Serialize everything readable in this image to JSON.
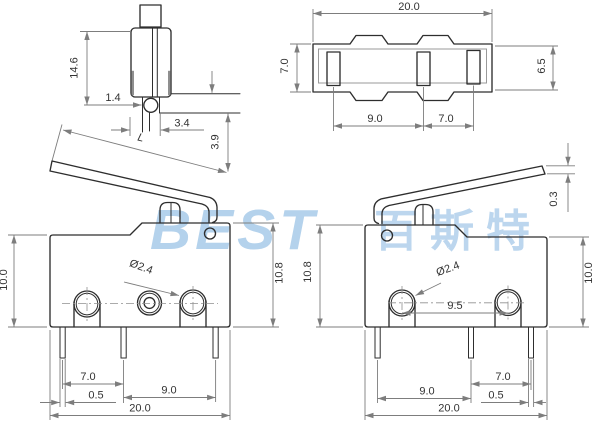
{
  "watermark": {
    "latin": "BEST",
    "cjk": "百斯特"
  },
  "colors": {
    "background": "#ffffff",
    "outline": "#2e2e2e",
    "dimension_lines": "#7d7d7d",
    "label_text": "#333333",
    "watermark_blue": "#b4d2ec"
  },
  "views": {
    "plunger_detail": {
      "dims": {
        "height": "14.6",
        "pin_offset": "1.4",
        "base_width": "3.4",
        "overtravel": "3.9",
        "lever_length": "L"
      }
    },
    "bottom_view": {
      "dims": {
        "width": "20.0",
        "depth": "7.0",
        "inner_depth": "6.5",
        "terminal_pitch_left": "9.0",
        "terminal_pitch_right": "7.0"
      }
    },
    "front_view_left": {
      "dims": {
        "body_height": "10.0",
        "total_height": "10.8",
        "hole_diameter": "Ø2.4",
        "pin_pitch_a": "7.0",
        "pin_width": "0.5",
        "pin_pitch_b": "9.0",
        "width": "20.0"
      }
    },
    "front_view_right": {
      "dims": {
        "lever_thickness": "0.3",
        "total_height": "10.8",
        "hole_diameter": "Ø2.4",
        "hole_pitch": "9.5",
        "body_height": "10.0",
        "pin_pitch_a": "9.0",
        "pin_pitch_b": "7.0",
        "pin_width": "0.5",
        "width": "20.0"
      }
    }
  }
}
